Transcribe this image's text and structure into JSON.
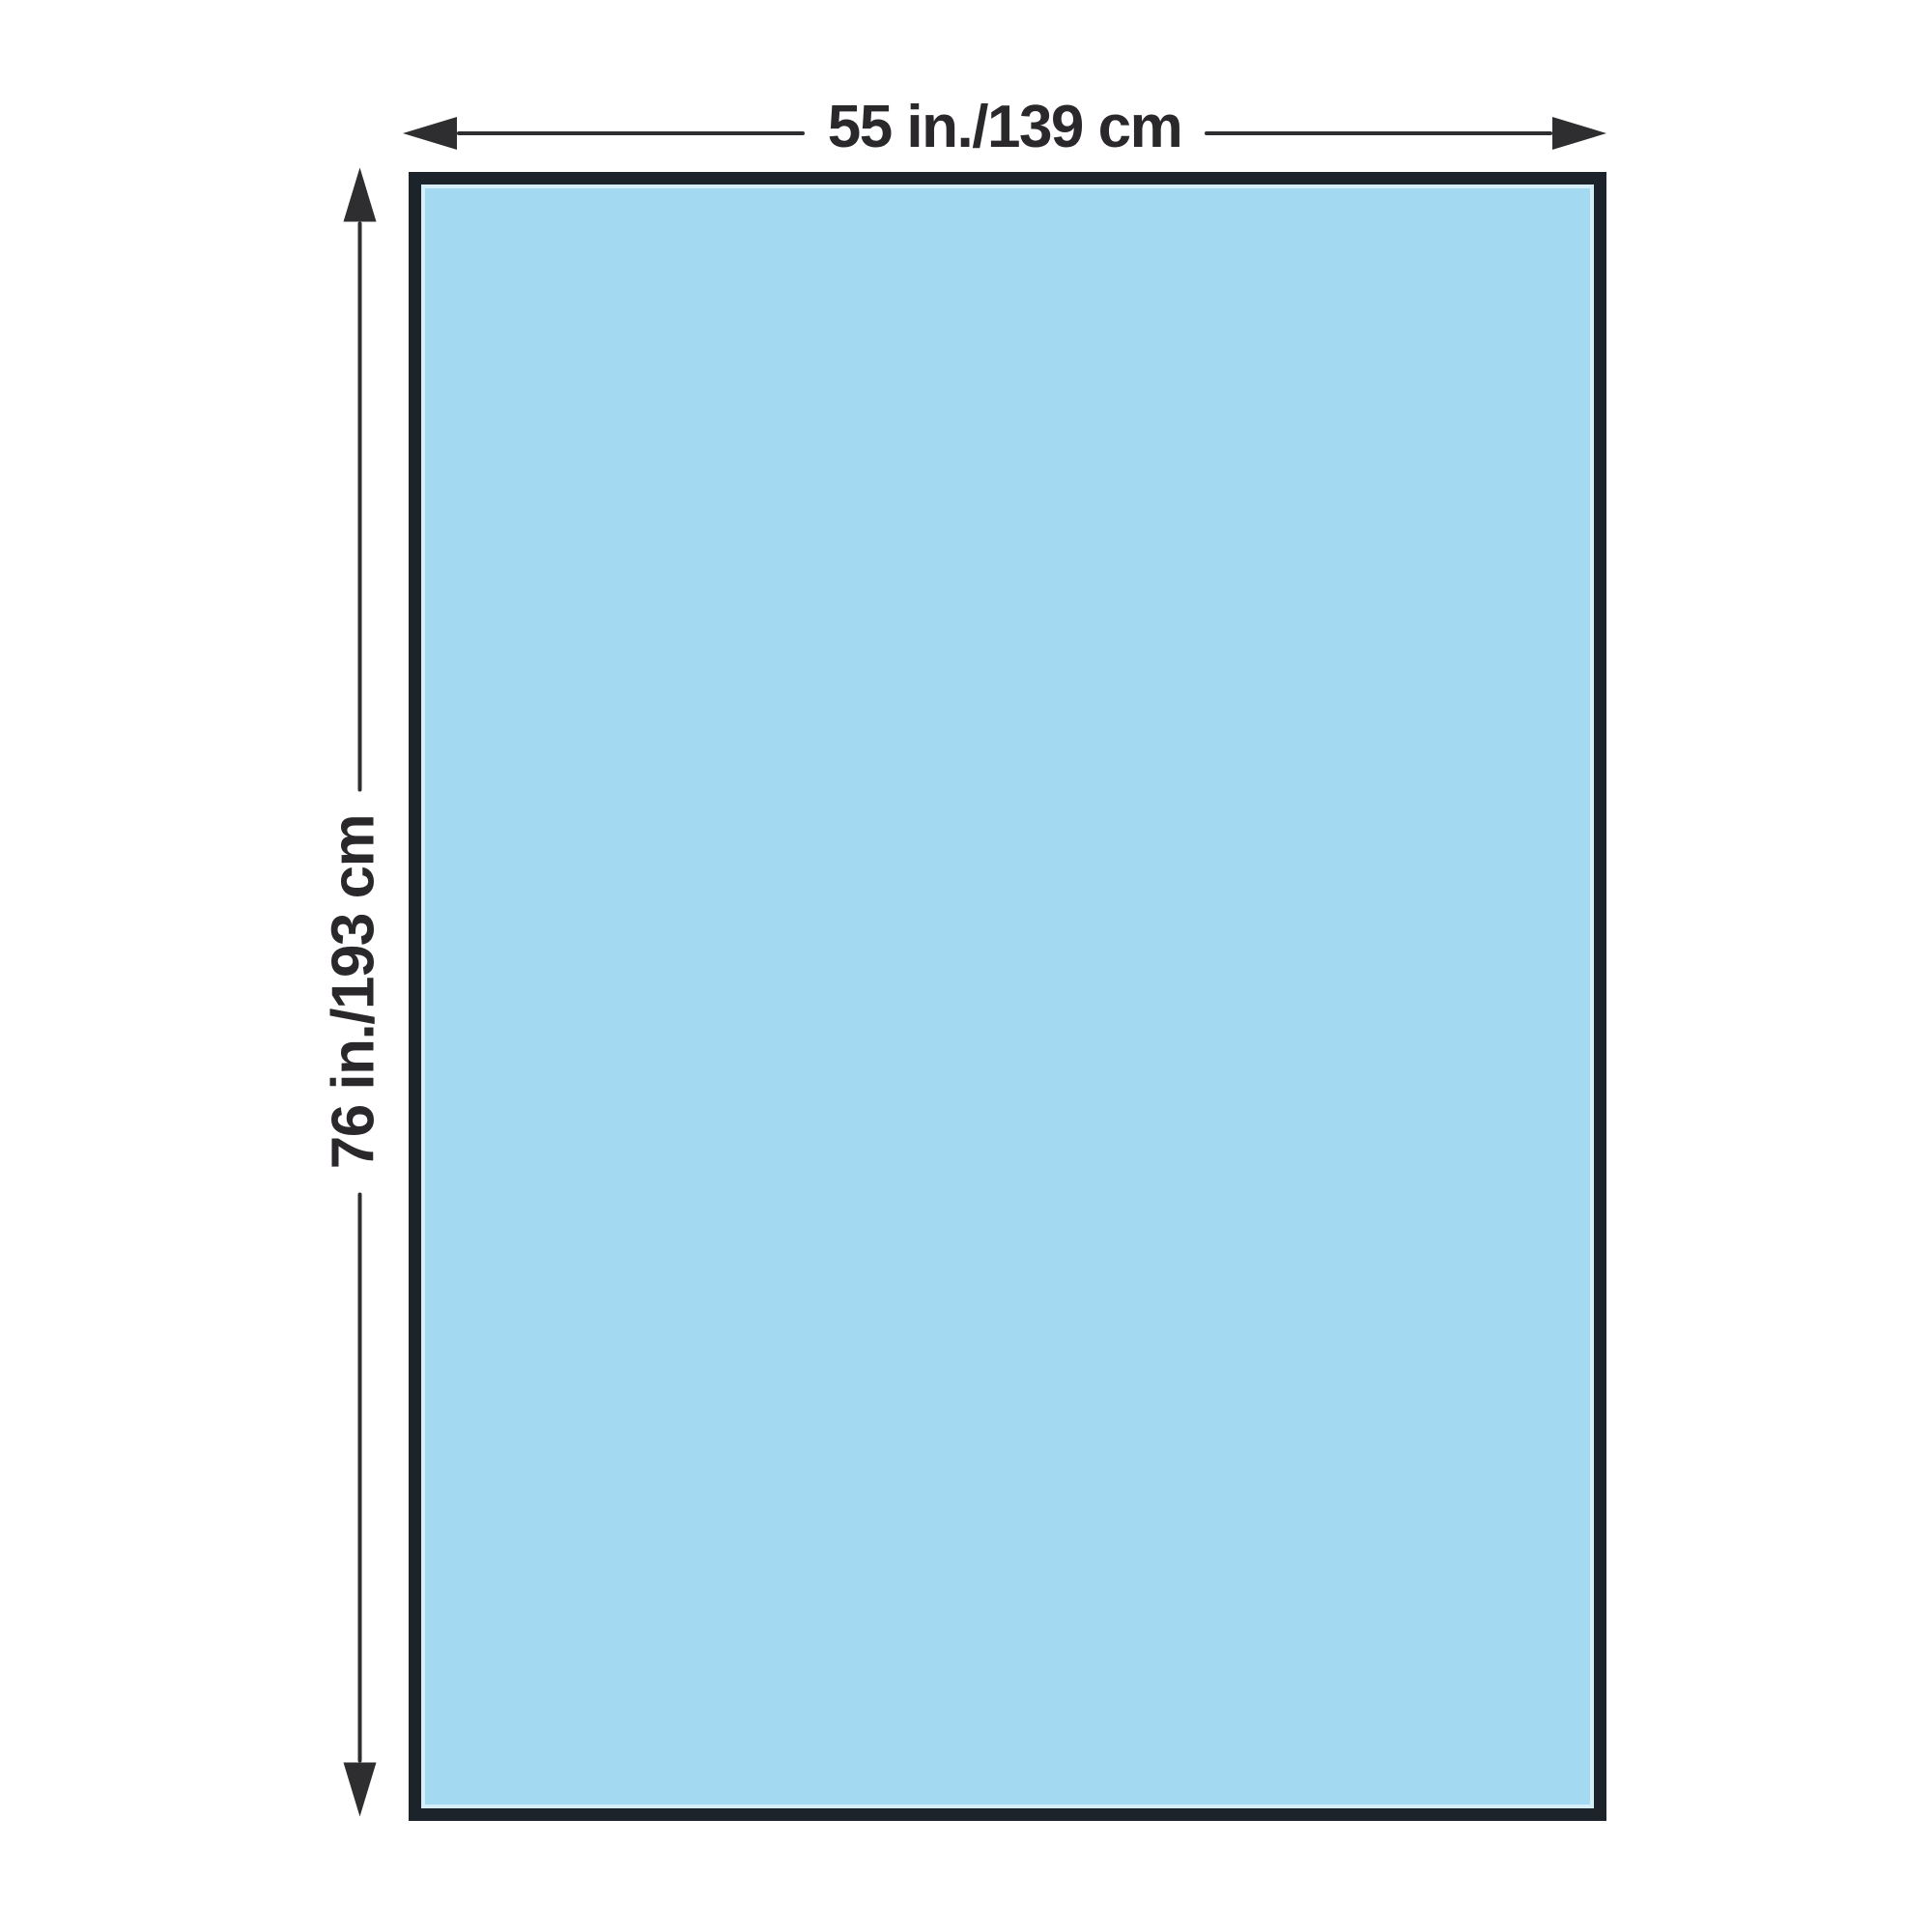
{
  "diagram": {
    "type": "product-dimension-diagram",
    "drape": {
      "width_label": "55 in./139 cm",
      "height_label": "76 in./193 cm"
    },
    "icons": {
      "horizontal_start": "arrow-left-icon",
      "horizontal_end": "arrow-right-icon",
      "vertical_top": "arrow-up-icon",
      "vertical_bottom": "arrow-down-icon"
    },
    "colors": {
      "background": "#ffffff",
      "drape_fill": "#a4d9f2",
      "drape_border": "#1d232b",
      "dimension_lines": "#2e2e30",
      "label_text": "#2a282b"
    }
  }
}
